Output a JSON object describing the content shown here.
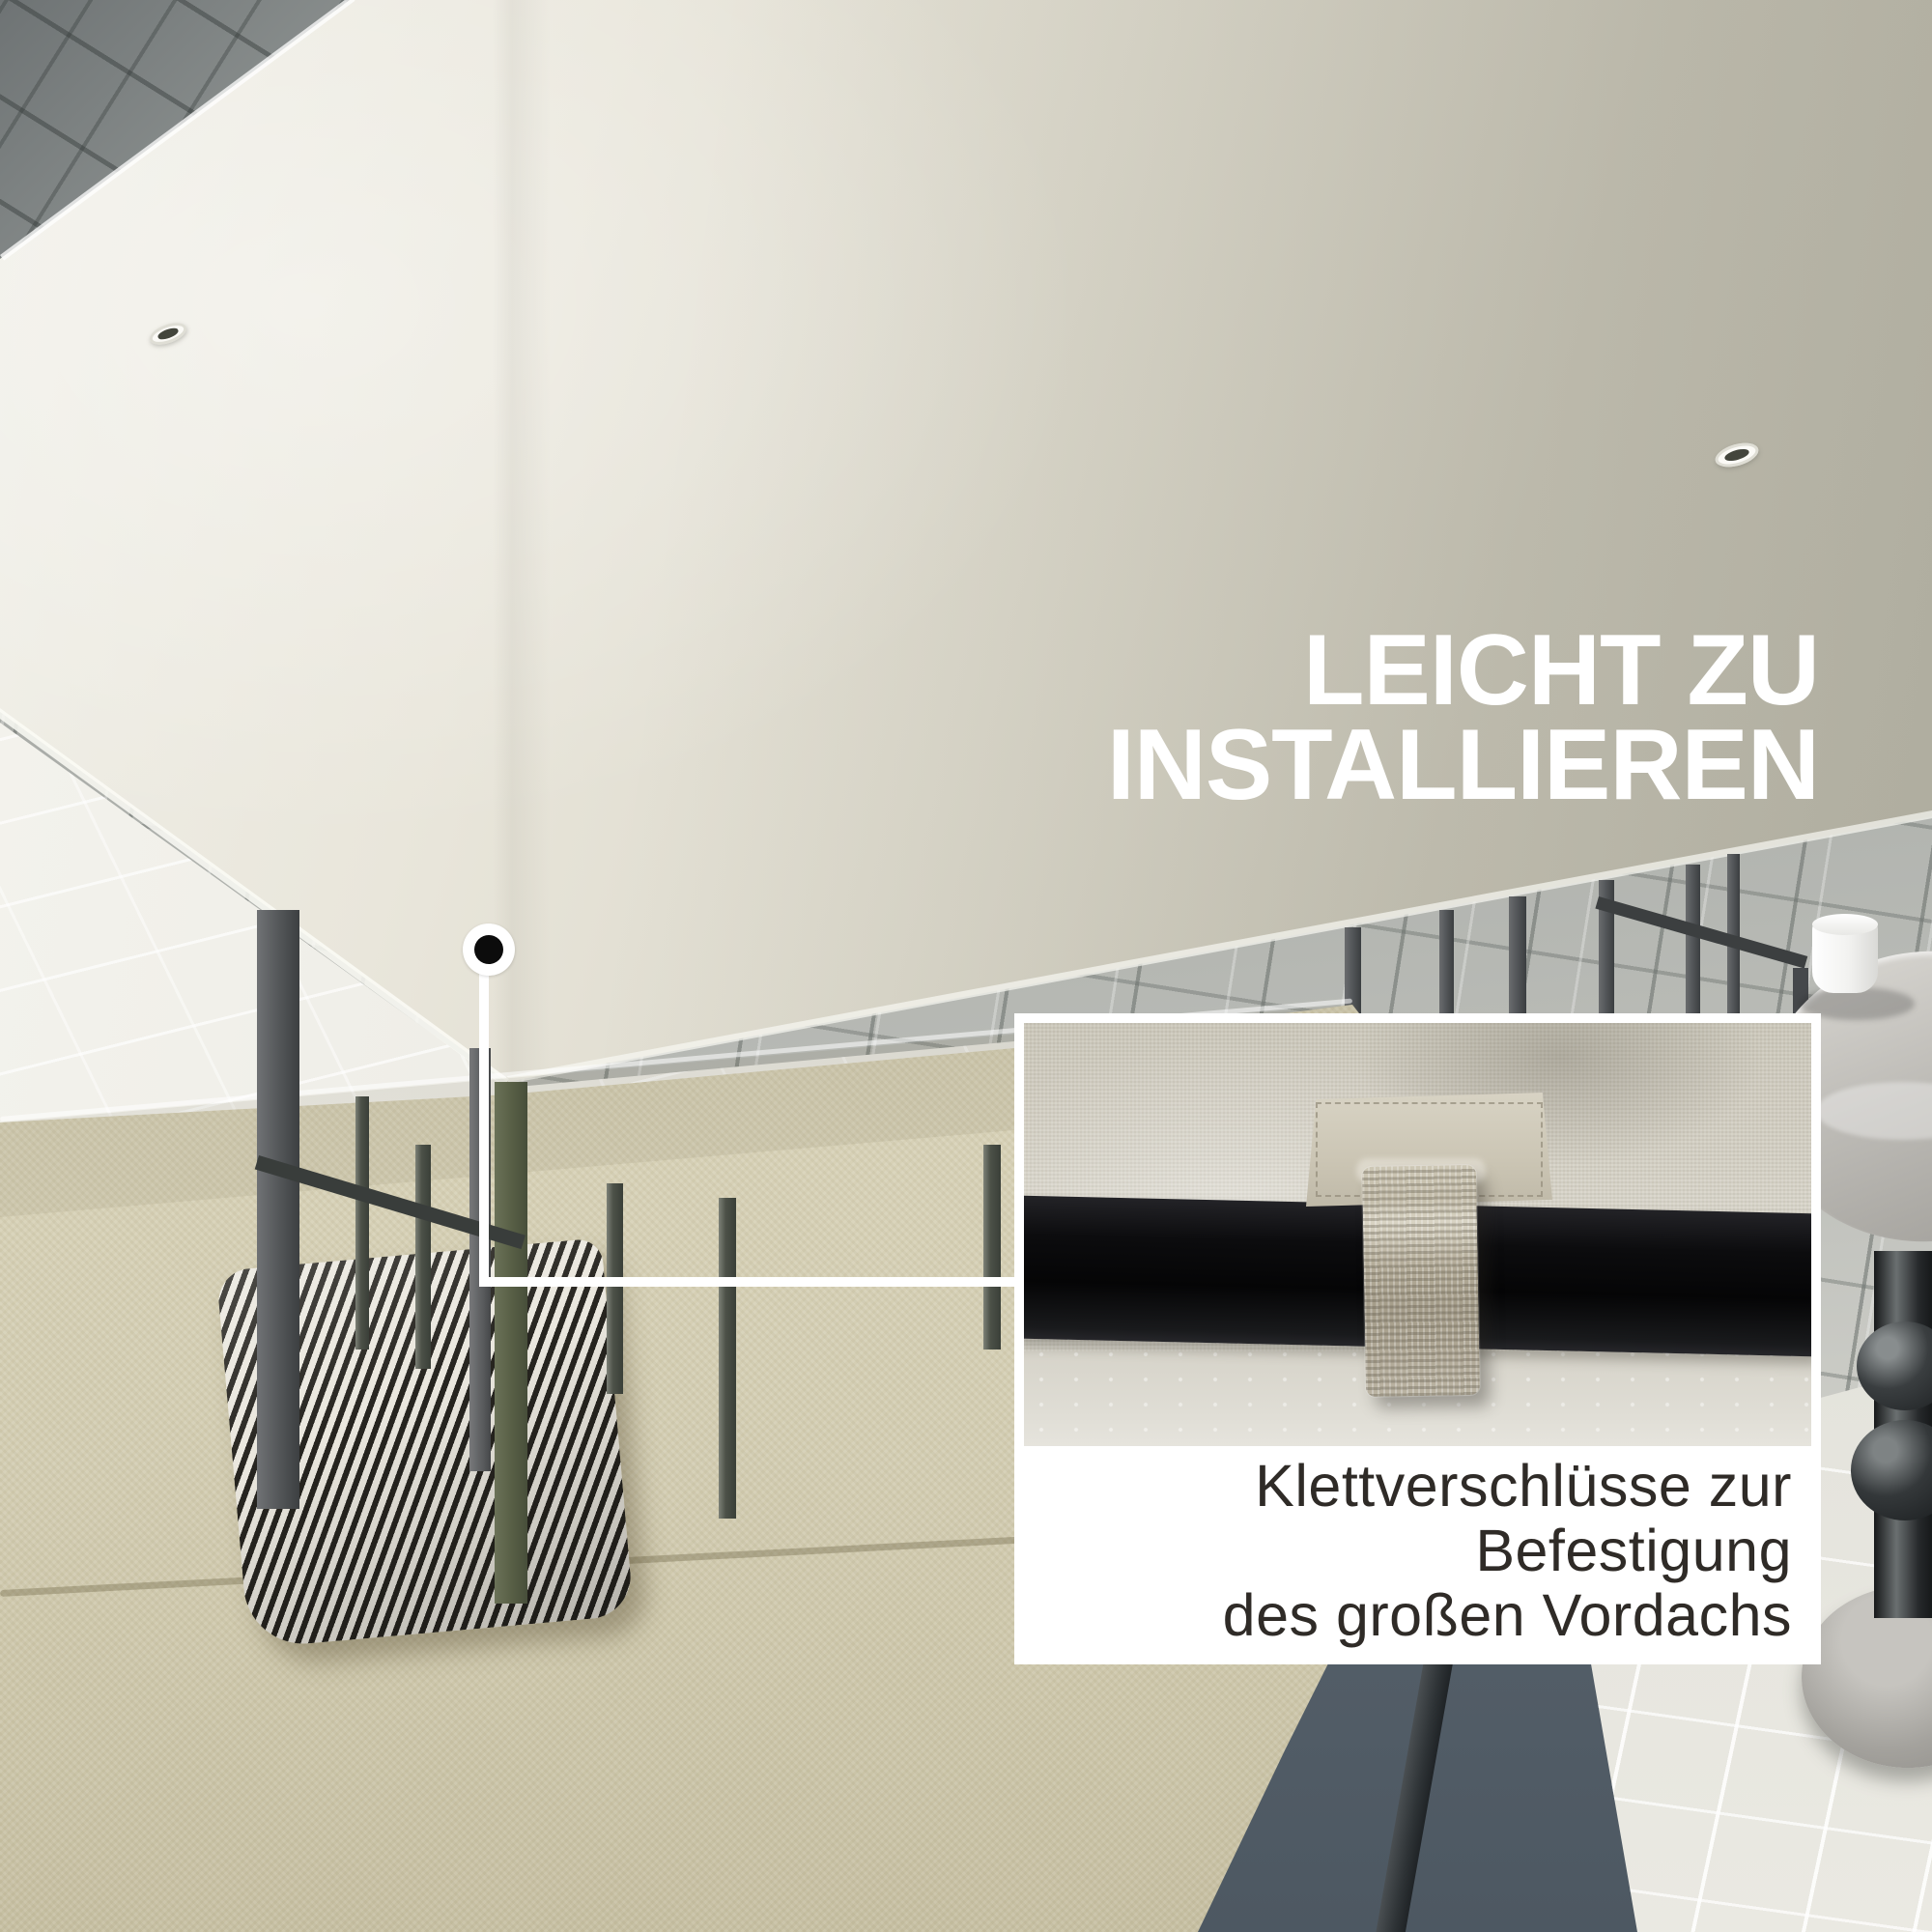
{
  "headline": {
    "lines": [
      "LEICHT ZU",
      "INSTALLIEREN"
    ],
    "color": "#ffffff"
  },
  "inset": {
    "caption_lines": [
      "Klettverschlüsse zur",
      "Befestigung",
      "des großen Vordachs"
    ],
    "caption_color": "#2f2b27",
    "background": "#ffffff",
    "photo_subject": "velcro-strap-on-black-frame-bar"
  },
  "callout": {
    "marker": "dot-with-connector-line",
    "line_color": "#ffffff"
  },
  "scene": {
    "canopy_color": "#e9e6db",
    "canopy_shadow_color": "#c7c5b7",
    "frame_olive": "#575e45",
    "frame_gray": "#54575a",
    "sofa_beige": "#d2cbae",
    "pillow_dark": "#26241f",
    "pillow_light": "#eae7de",
    "paver_gray": "#b2b5b1",
    "paver_dark": "#7e8384",
    "paver_bright": "#e2e1da",
    "table_cup_color": "#ffffff"
  }
}
